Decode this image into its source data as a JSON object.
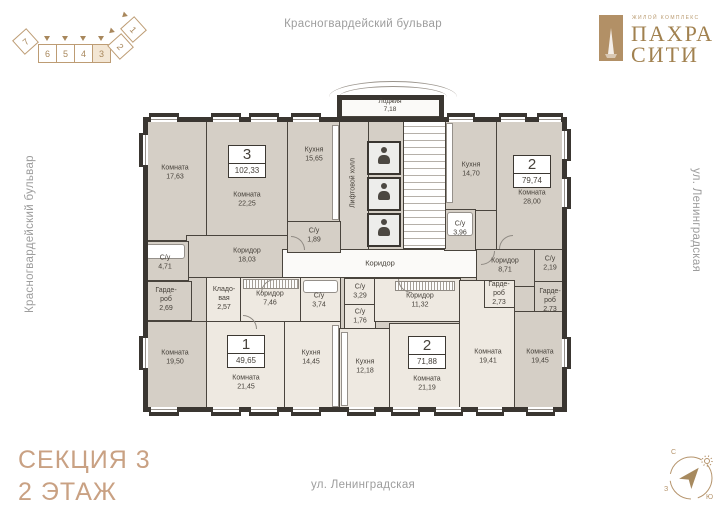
{
  "streets": {
    "top": "Красногвардейский бульвар",
    "left": "Красногвардейский бульвар",
    "right": "ул. Ленинградская",
    "bottom": "ул. Ленинградская"
  },
  "footer": {
    "section": "СЕКЦИЯ 3",
    "floor": "2 ЭТАЖ"
  },
  "logo": {
    "subtitle": "ЖИЛОЙ КОМПЛЕКС",
    "line1": "ПАХРА",
    "line2": "СИТИ"
  },
  "minimap": {
    "sections": [
      "7",
      "6",
      "5",
      "4",
      "3",
      "2",
      "1"
    ],
    "active": "3"
  },
  "compass": {
    "north": "С",
    "west": "З",
    "south": "Ю"
  },
  "colors": {
    "accent": "#a8875c",
    "apartment_dark": "#d5cfc6",
    "apartment_light": "#eee9e1",
    "wall": "#3a3631",
    "title": "#c9a183"
  },
  "plan": {
    "badges": {
      "apt3": {
        "num": "3",
        "area": "102,33"
      },
      "apt1": {
        "num": "1",
        "area": "49,65"
      },
      "apt2t": {
        "num": "2",
        "area": "79,74"
      },
      "apt2b": {
        "num": "2",
        "area": "71,88"
      }
    },
    "rooms": {
      "loggia": {
        "name": "Лоджия",
        "area": "7,18"
      },
      "lift_hall": {
        "name": "Лифтовой холл"
      },
      "corridor": {
        "name": "Коридор"
      },
      "a3_room1": {
        "name": "Комната",
        "area": "17,63"
      },
      "a3_room2": {
        "name": "Комната",
        "area": "22,25"
      },
      "a3_kitchen": {
        "name": "Кухня",
        "area": "15,65"
      },
      "a3_su1": {
        "name": "С/у",
        "area": "4,71"
      },
      "a3_su2": {
        "name": "С/у",
        "area": "1,89"
      },
      "a3_corr": {
        "name": "Коридор",
        "area": "18,03"
      },
      "a3_ward": {
        "name": "Гарде-роб",
        "area": "2,69"
      },
      "a3_room3": {
        "name": "Комната",
        "area": "19,50"
      },
      "a1_store": {
        "name": "Кладо-вая",
        "area": "2,57"
      },
      "a1_corr": {
        "name": "Коридор",
        "area": "7,46"
      },
      "a1_su": {
        "name": "С/у",
        "area": "3,74"
      },
      "a1_room": {
        "name": "Комната",
        "area": "21,45"
      },
      "a1_kitchen": {
        "name": "Кухня",
        "area": "14,45"
      },
      "a2b_su1": {
        "name": "С/у",
        "area": "3,29"
      },
      "a2b_su2": {
        "name": "С/у",
        "area": "1,76"
      },
      "a2b_corr": {
        "name": "Коридор",
        "area": "11,32"
      },
      "a2b_kitchen": {
        "name": "Кухня",
        "area": "12,18"
      },
      "a2b_room1": {
        "name": "Комната",
        "area": "21,19"
      },
      "a2b_room2": {
        "name": "Комната",
        "area": "19,41"
      },
      "a2b_ward": {
        "name": "Гарде-роб",
        "area": "2,73"
      },
      "a2t_kitchen": {
        "name": "Кухня",
        "area": "14,70"
      },
      "a2t_room1": {
        "name": "Комната",
        "area": "28,00"
      },
      "a2t_su1": {
        "name": "С/у",
        "area": "3,96"
      },
      "a2t_corr": {
        "name": "Коридор",
        "area": "8,71"
      },
      "a2t_su2": {
        "name": "С/у",
        "area": "2,19"
      },
      "a2t_ward": {
        "name": "Гарде-роб",
        "area": "2,73"
      },
      "a2t_room2": {
        "name": "Комната",
        "area": "19,45"
      }
    }
  }
}
